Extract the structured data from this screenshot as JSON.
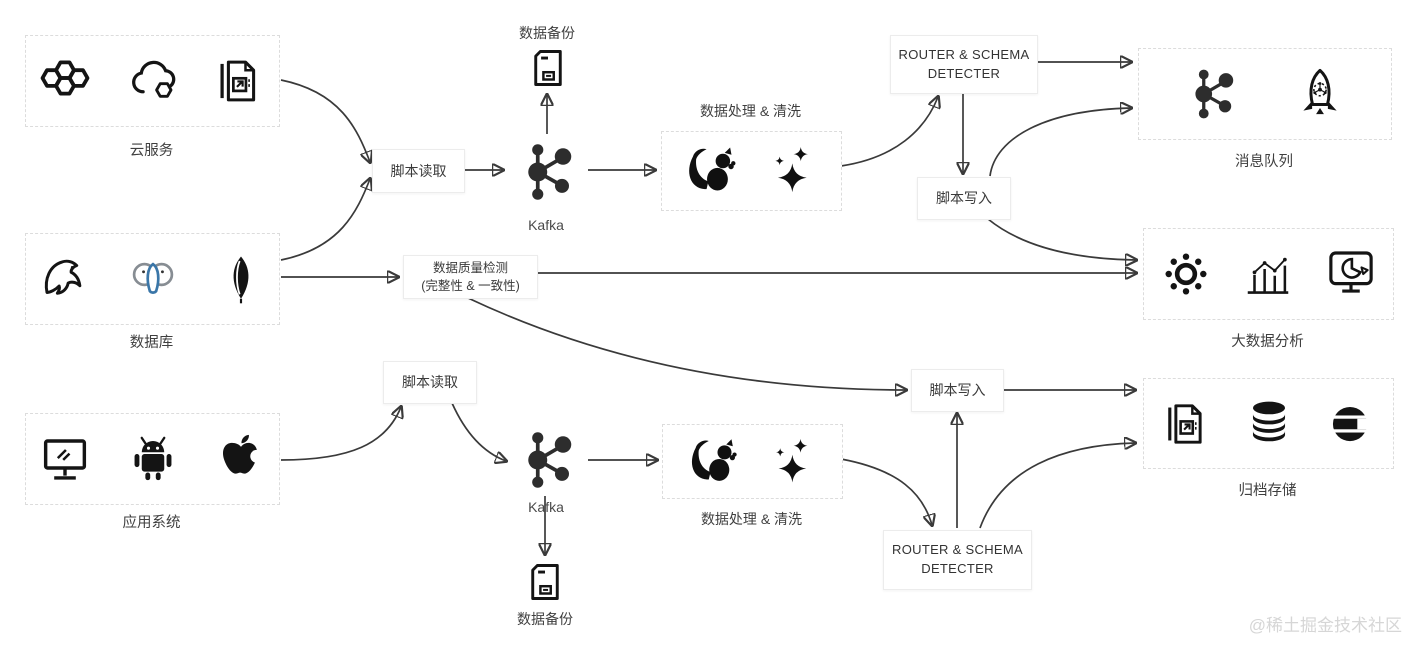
{
  "diagram": {
    "sources": {
      "cloud_services": {
        "label": "云服务",
        "icons": [
          "hexagon-cluster-icon",
          "cloud-icon",
          "file-export-icon"
        ]
      },
      "databases": {
        "label": "数据库",
        "icons": [
          "mysql-dolphin-icon",
          "postgresql-elephant-icon",
          "mongodb-leaf-icon"
        ]
      },
      "app_systems": {
        "label": "应用系统",
        "icons": [
          "desktop-monitor-icon",
          "android-icon",
          "apple-icon"
        ]
      }
    },
    "pipeline_top": {
      "script_read": "脚本读取",
      "kafka": "Kafka",
      "backup": "数据备份",
      "processing": "数据处理 & 清洗",
      "router_line1": "ROUTER & SCHEMA",
      "router_line2": "DETECTER",
      "script_write": "脚本写入"
    },
    "pipeline_bottom": {
      "script_read": "脚本读取",
      "kafka": "Kafka",
      "backup": "数据备份",
      "processing": "数据处理 & 清洗",
      "router_line1": "ROUTER & SCHEMA",
      "router_line2": "DETECTER",
      "script_write": "脚本写入"
    },
    "quality_check": {
      "line1": "数据质量检测",
      "line2": "(完整性 & 一致性)"
    },
    "sinks": {
      "message_queue": {
        "label": "消息队列",
        "icons": [
          "kafka-node-icon",
          "rocketmq-rocket-icon"
        ]
      },
      "bigdata": {
        "label": "大数据分析",
        "icons": [
          "node-cluster-icon",
          "bar-line-chart-icon",
          "monitor-pie-chart-icon"
        ]
      },
      "archive": {
        "label": "归档存储",
        "icons": [
          "file-export-icon",
          "database-cylinder-icon",
          "elasticsearch-icon"
        ]
      }
    },
    "watermark": "@稀土掘金技术社区"
  },
  "colors": {
    "icon_black": "#141414",
    "postgres_blue": "#3a76a8",
    "elephant_gray": "#878d93",
    "arrow": "#3a3a3a",
    "box_border_dashed": "#dcdcdc",
    "box_border_solid": "#ececec",
    "text": "#3d3d3d",
    "watermark": "#d6d6d6"
  }
}
